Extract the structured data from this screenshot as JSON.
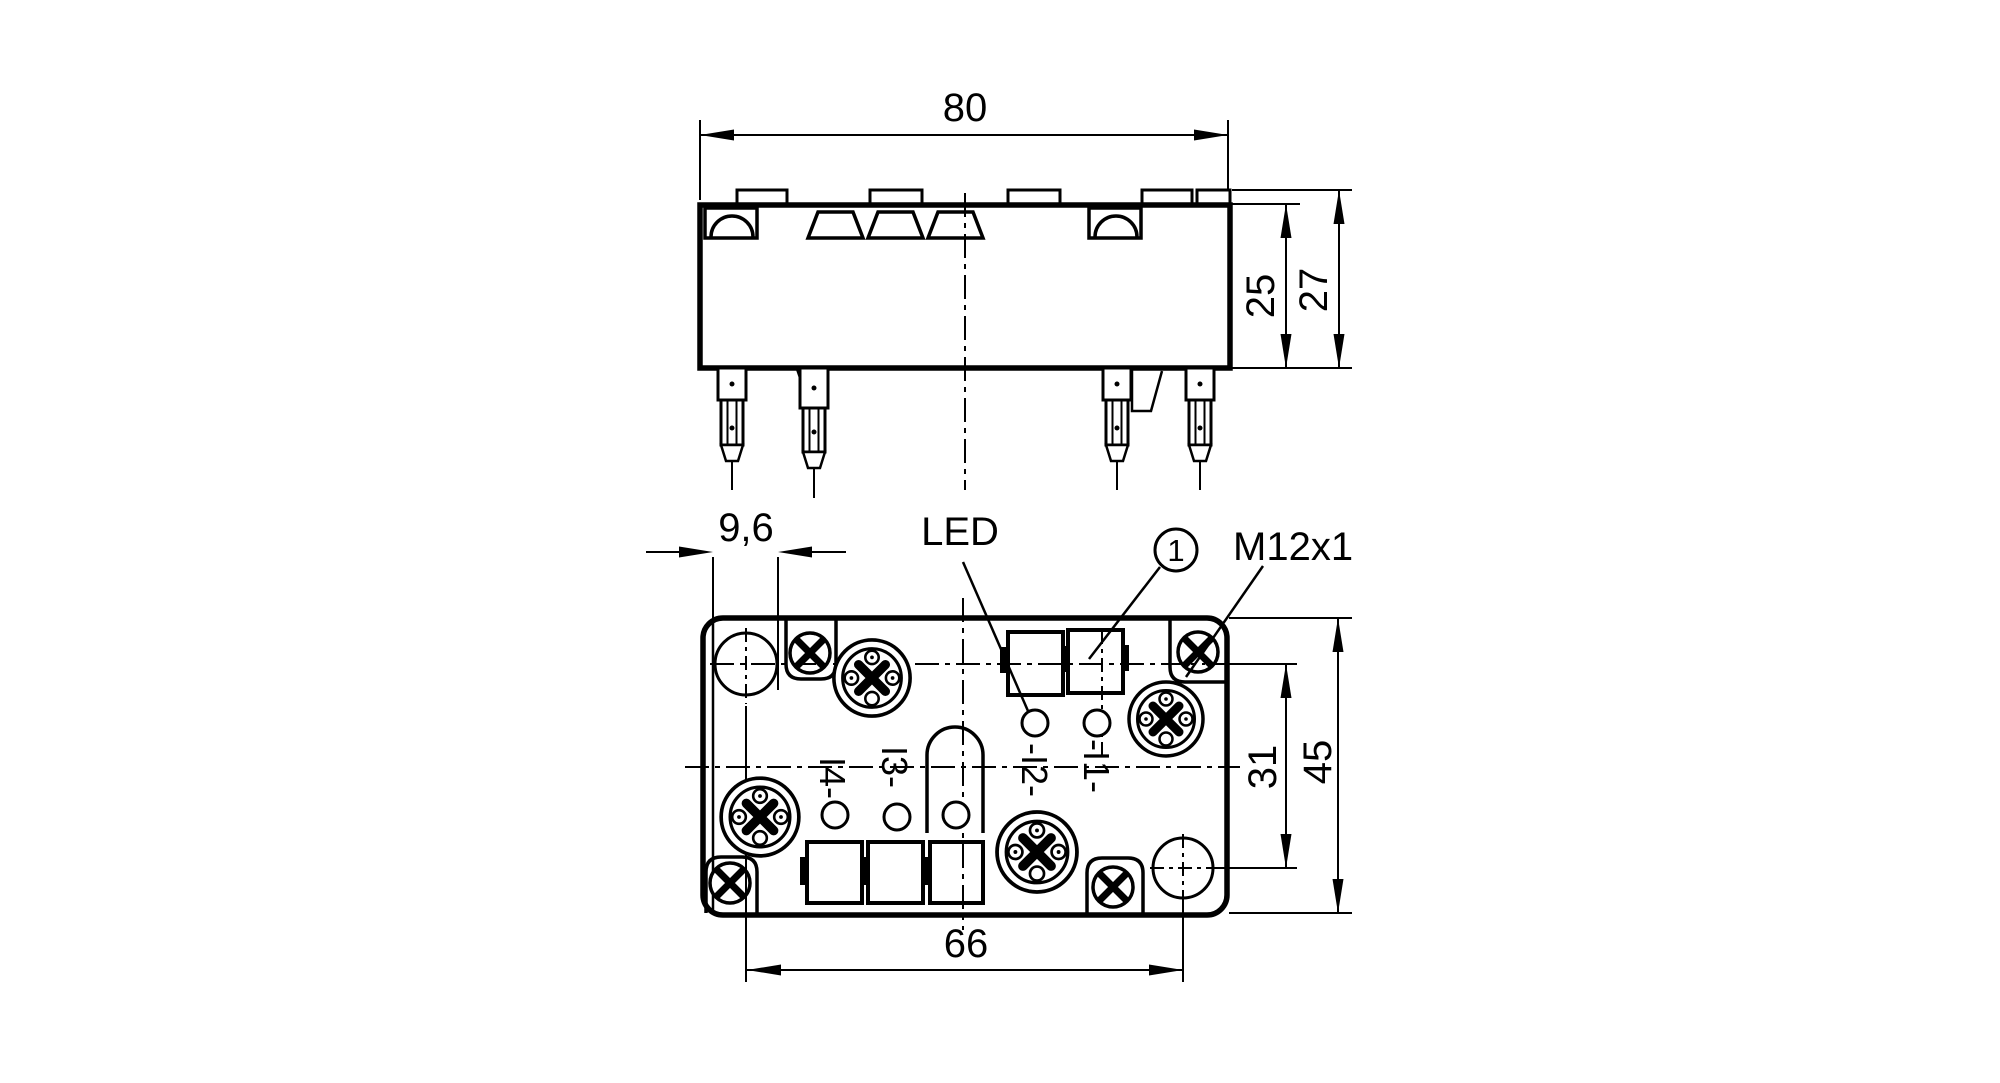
{
  "top_view": {
    "dim_width": "80",
    "dim_height_body": "25",
    "dim_height_total": "27"
  },
  "bottom_view": {
    "dim_edge_offset": "9,6",
    "dim_mount_spacing": "66",
    "dim_row_spacing": "31",
    "dim_depth": "45",
    "led_label": "LED",
    "callout_1": "1",
    "thread_label": "M12x1",
    "ports": [
      {
        "label": "I4-"
      },
      {
        "label": "I3-"
      },
      {
        "label": "-I2-"
      },
      {
        "label": "-I1-"
      }
    ]
  },
  "colors": {
    "line": "#000000",
    "background": "#ffffff"
  }
}
